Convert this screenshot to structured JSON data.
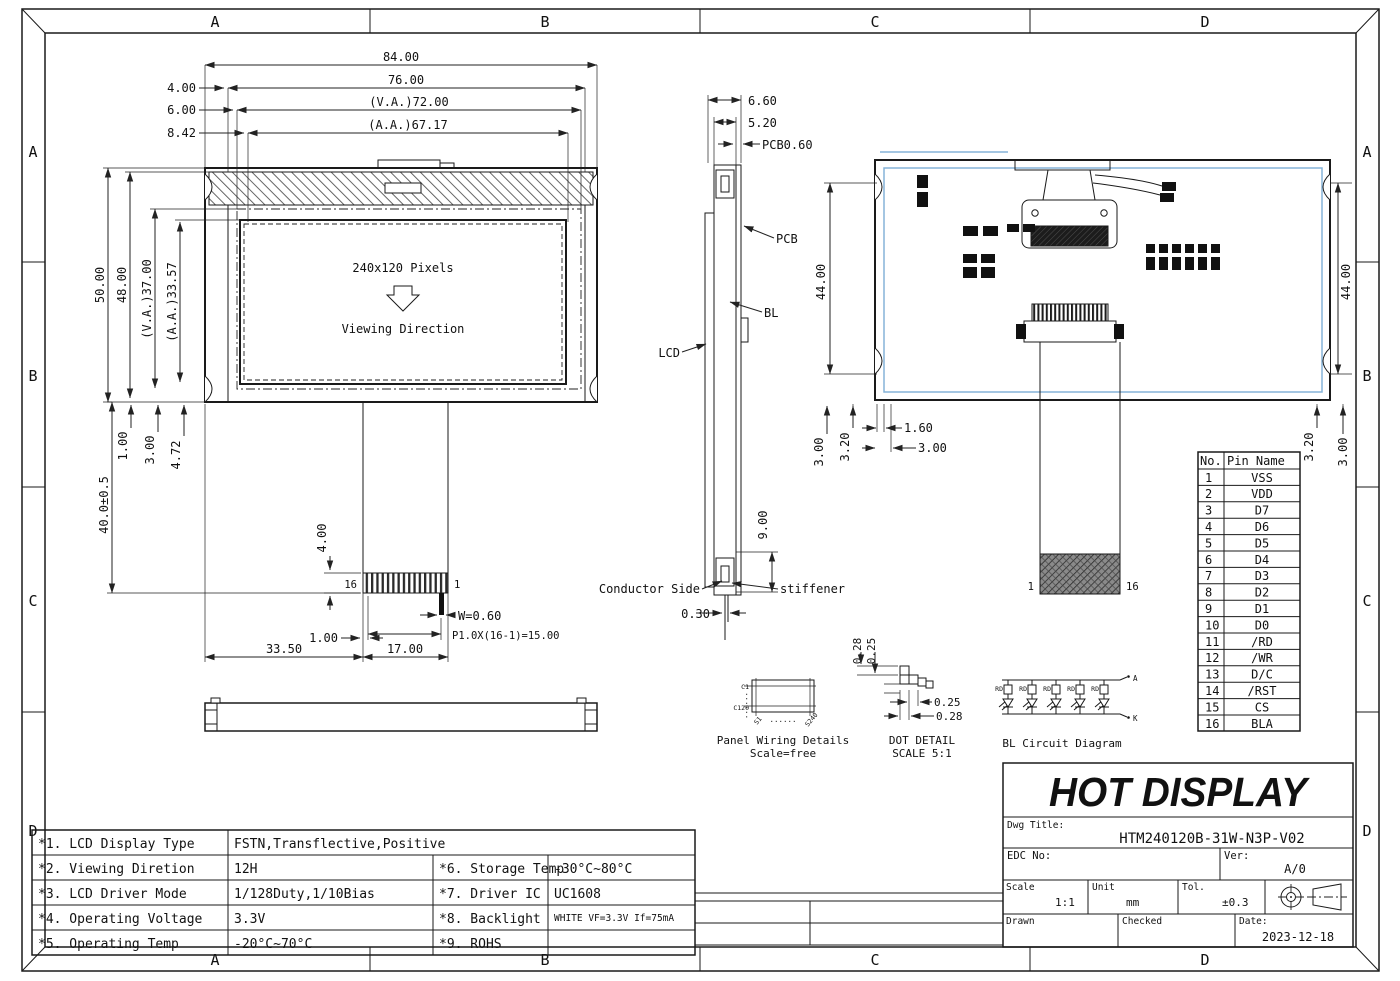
{
  "colors": {
    "line": "#1a1a1a",
    "accent_blue": "#85b3d8"
  },
  "frame": {
    "zones": [
      "A",
      "B",
      "C",
      "D"
    ]
  },
  "front": {
    "w_total": "84.00",
    "w_outer": "76.00",
    "w_va": "(V.A.)72.00",
    "w_aa": "(A.A.)67.17",
    "off_4": "4.00",
    "off_6": "6.00",
    "off_8_42": "8.42",
    "h_total": "50.00",
    "h_48": "48.00",
    "h_va": "(V.A.)37.00",
    "h_aa": "(A.A.)33.57",
    "off_1": "1.00",
    "off_3": "3.00",
    "off_4_72": "4.72",
    "tail_len": "40.0±0.5",
    "screen_text": "240x120 Pixels",
    "viewing_text": "Viewing Direction",
    "pin_16": "16",
    "pin_1": "1",
    "pin_len": "4.00",
    "pin_width": "W=0.60",
    "pin_pitch": "P1.0X(16-1)=15.00",
    "off_1b": "1.00",
    "d_33_5": "33.50",
    "d_17": "17.00"
  },
  "side": {
    "d_6_6": "6.60",
    "d_5_2": "5.20",
    "d_pcb": "PCB0.60",
    "lbl_pcb": "PCB",
    "lbl_bl": "BL",
    "lbl_lcd": "LCD",
    "lbl_conductor": "Conductor Side",
    "lbl_stiffener": "stiffener",
    "d_9": "9.00",
    "d_0_3": "0.30"
  },
  "back": {
    "d_44_l": "44.00",
    "d_44_r": "44.00",
    "d_3_l": "3.00",
    "d_3_2_l": "3.20",
    "d_1_6": "1.60",
    "d_3_b": "3.00",
    "d_3_2_r": "3.20",
    "d_3_r": "3.00",
    "pin_1": "1",
    "pin_16": "16"
  },
  "pin_table": {
    "col_no": "No.",
    "col_name": "Pin Name",
    "rows": [
      {
        "no": "1",
        "name": "VSS"
      },
      {
        "no": "2",
        "name": "VDD"
      },
      {
        "no": "3",
        "name": "D7"
      },
      {
        "no": "4",
        "name": "D6"
      },
      {
        "no": "5",
        "name": "D5"
      },
      {
        "no": "6",
        "name": "D4"
      },
      {
        "no": "7",
        "name": "D3"
      },
      {
        "no": "8",
        "name": "D2"
      },
      {
        "no": "9",
        "name": "D1"
      },
      {
        "no": "10",
        "name": "D0"
      },
      {
        "no": "11",
        "name": "/RD"
      },
      {
        "no": "12",
        "name": "/WR"
      },
      {
        "no": "13",
        "name": "D/C"
      },
      {
        "no": "14",
        "name": "/RST"
      },
      {
        "no": "15",
        "name": "CS"
      },
      {
        "no": "16",
        "name": "BLA"
      }
    ]
  },
  "panel_wiring": {
    "title": "Panel Wiring Details",
    "scale": "Scale=free",
    "c_first": "C1",
    "c_last": "C120",
    "s_first": "S1",
    "s_last": "S240",
    "dots": "......"
  },
  "dot_detail": {
    "title": "DOT DETAIL",
    "scale": "SCALE 5:1",
    "d_top_1": "0.28",
    "d_top_2": "0.25",
    "d_right_1": "0.25",
    "d_right_2": "0.28"
  },
  "bl_circuit": {
    "title": "BL Circuit Diagram",
    "res_label": "RD",
    "anode": "A",
    "cathode": "K"
  },
  "spec_table": {
    "rows": [
      {
        "label": "*1. LCD Display Type",
        "value": "FSTN,Transflective,Positive",
        "label2": "",
        "value2": ""
      },
      {
        "label": "*2. Viewing Diretion",
        "value": "12H",
        "label2": "*6. Storage Temp",
        "value2": "-30°C~80°C"
      },
      {
        "label": "*3. LCD Driver Mode",
        "value": "1/128Duty,1/10Bias",
        "label2": "*7. Driver IC",
        "value2": "UC1608"
      },
      {
        "label": "*4. Operating Voltage",
        "value": "3.3V",
        "label2": "*8. Backlight",
        "value2": "WHITE VF=3.3V If=75mA"
      },
      {
        "label": "*5. Operating Temp",
        "value": "-20°C~70°C",
        "label2": "*9. ROHS",
        "value2": ""
      }
    ]
  },
  "title_block": {
    "company": "HOT DISPLAY",
    "dwg_label": "Dwg Title:",
    "dwg_title": "HTM240120B-31W-N3P-V02",
    "edc_label": "EDC No:",
    "ver_label": "Ver:",
    "ver": "A/0",
    "scale_label": "Scale",
    "scale": "1:1",
    "unit_label": "Unit",
    "unit": "mm",
    "tol_label": "Tol.",
    "tol": "±0.3",
    "drawn_label": "Drawn",
    "checked_label": "Checked",
    "date_label": "Date:",
    "date": "2023-12-18"
  }
}
